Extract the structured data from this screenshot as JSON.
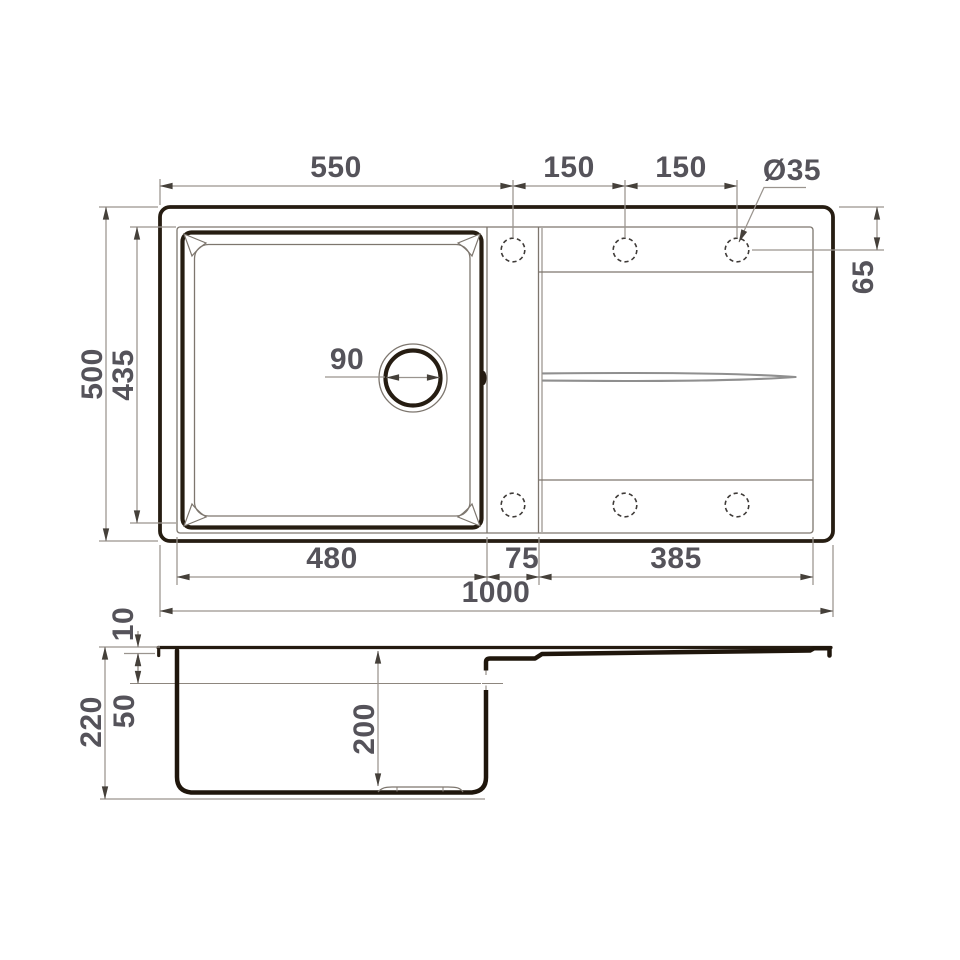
{
  "drawing": {
    "type": "kitchen sink technical drawing, top view and side section",
    "colors": {
      "background": "#ffffff",
      "outline_thick": "#261d12",
      "outline_thin": "#7d766e",
      "dimension_line": "#9a948e",
      "dimension_text": "#55535a",
      "arrowhead": "#45403a",
      "channel_gray": "#8f8f8f"
    }
  },
  "top_view": {
    "label_top_width": "550",
    "label_hole_pitch_1": "150",
    "label_hole_pitch_2": "150",
    "label_hole_diameter": "Ø35",
    "label_overall_depth": "500",
    "label_bowl_cutout_depth": "435",
    "label_drain_diameter": "90",
    "label_hole_offset": "65",
    "label_bowl_width": "480",
    "label_gap_width": "75",
    "label_drainboard_width": "385",
    "label_overall_width": "1000"
  },
  "side_view": {
    "label_rim_height": "10",
    "label_overall_height": "220",
    "label_overflow_level": "50",
    "label_bowl_depth": "200"
  }
}
